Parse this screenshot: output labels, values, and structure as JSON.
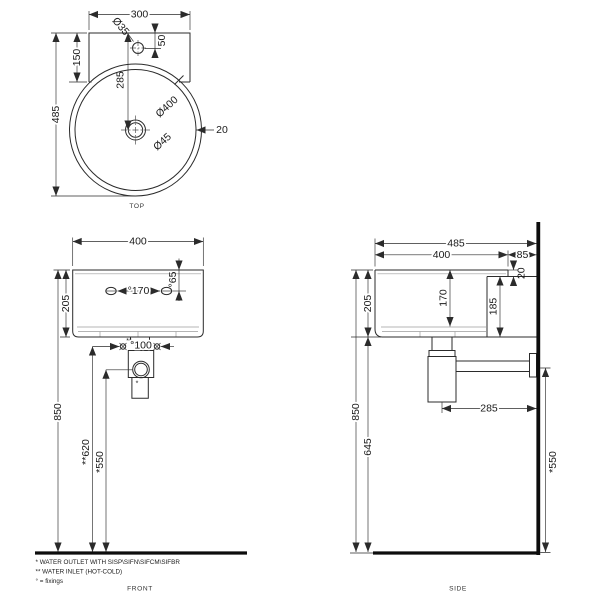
{
  "views": {
    "top": {
      "label": "TOP",
      "dims": {
        "width": "300",
        "total_depth": "485",
        "ledge_depth": "150",
        "tap_hole_dia": "Ø35",
        "tap_offset": "50",
        "drain_setback": "285",
        "basin_dia": "Ø400",
        "drain_dia": "Ø45",
        "rim_thickness": "20"
      }
    },
    "front": {
      "label": "FRONT",
      "dims": {
        "width": "400",
        "height": "205",
        "fixing_span": "°170",
        "fixing_offset": "°65",
        "inlet_span": "°100",
        "inlet_mark": "**",
        "outlet_mark": "*",
        "mount_height": "850",
        "inlet_height": "**620",
        "outlet_height": "*550"
      }
    },
    "side": {
      "label": "SIDE",
      "dims": {
        "total_depth": "485",
        "basin_depth": "400",
        "wall_offset": "85",
        "ledge_drop": "20",
        "height": "205",
        "bowl_depth": "170",
        "back_height": "185",
        "mount_height": "850",
        "clearance": "645",
        "trap_offset": "285",
        "outlet_height": "*550"
      }
    }
  },
  "notes": [
    "*  WATER OUTLET WITH SISP\\SIFN\\SIFCM\\SIFBR",
    "** WATER INLET  (HOT-COLD)",
    "° = fixings"
  ]
}
